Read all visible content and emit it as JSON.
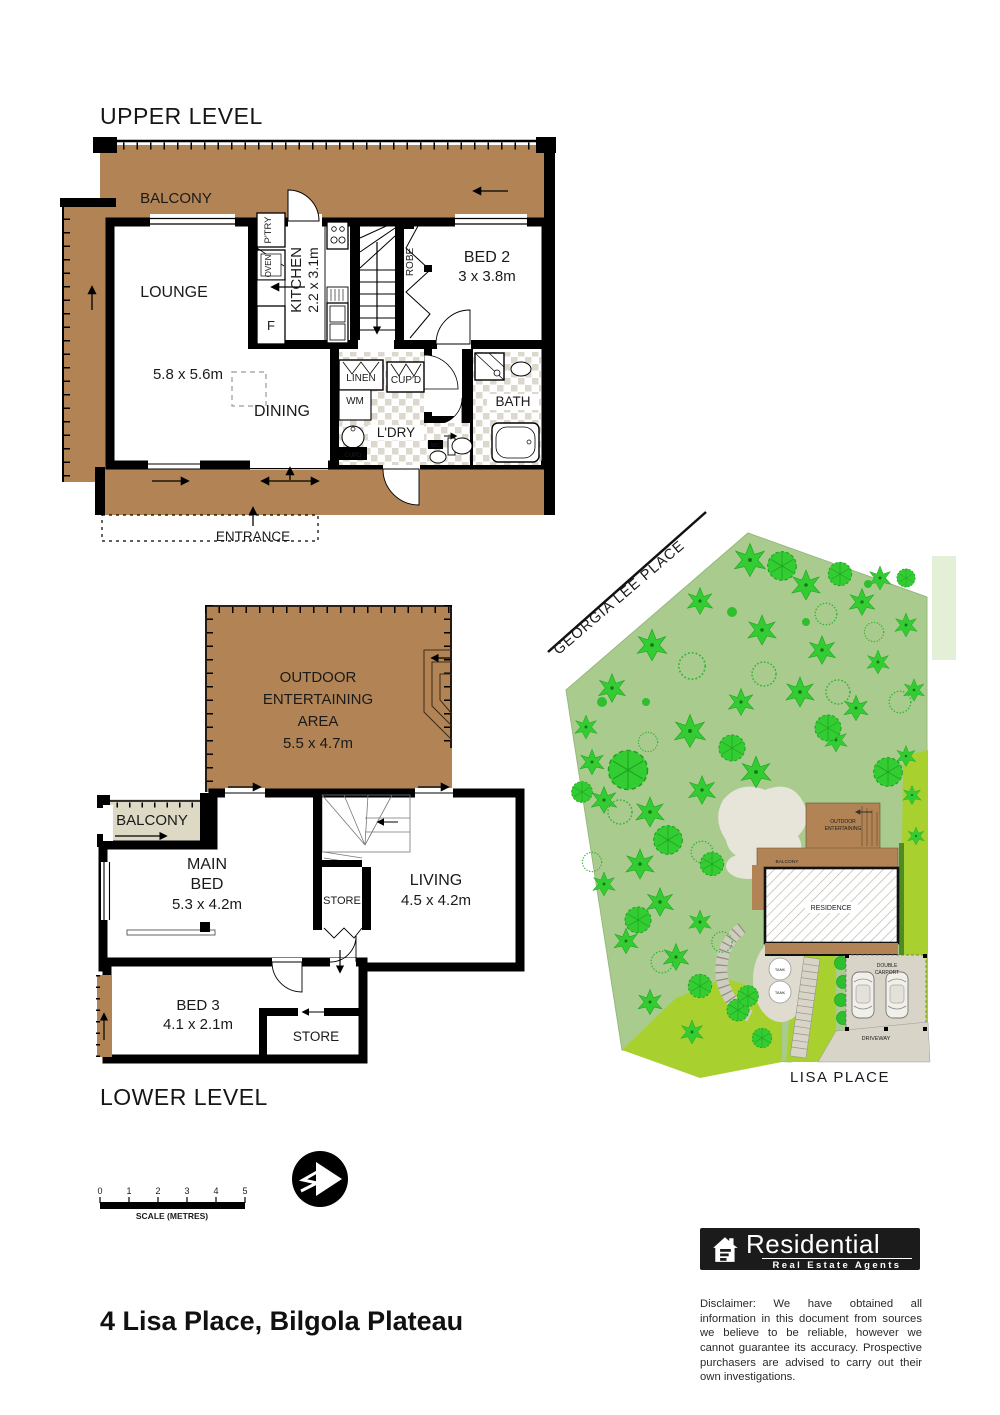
{
  "page": {
    "upper_title": "UPPER LEVEL",
    "lower_title": "LOWER LEVEL",
    "address": "4 Lisa Place, Bilgola Plateau"
  },
  "upper": {
    "balcony": "BALCONY",
    "lounge": "LOUNGE",
    "main_dim": "5.8 x 5.6m",
    "dining": "DINING",
    "kitchen": "KITCHEN",
    "kitchen_dim": "2.2 x 3.1m",
    "pantry": "P'TRY",
    "oven": "OVEN",
    "fridge": "F",
    "robe": "ROBE",
    "bed2": "BED 2",
    "bed2_dim": "3 x 3.8m",
    "linen": "LINEN",
    "cupboard": "CUP'D",
    "washing_machine": "WM",
    "laundry": "L'DRY",
    "cupboard_small": "CUPD",
    "bath": "BATH",
    "wc": "WC",
    "entrance": "ENTRANCE"
  },
  "lower": {
    "outdoor_line1": "OUTDOOR",
    "outdoor_line2": "ENTERTAINING",
    "outdoor_line3": "AREA",
    "outdoor_dim": "5.5 x 4.7m",
    "balcony": "BALCONY",
    "main_bed_line1": "MAIN",
    "main_bed_line2": "BED",
    "main_bed_dim": "5.3 x 4.2m",
    "store_mid": "STORE",
    "living": "LIVING",
    "living_dim": "4.5 x 4.2m",
    "bed3": "BED 3",
    "bed3_dim": "4.1 x 2.1m",
    "store_bottom": "STORE"
  },
  "site": {
    "street_top": "GEORGIA LEE PLACE",
    "street_bottom": "LISA PLACE",
    "outdoor_line1": "OUTDOOR",
    "outdoor_line2": "ENTERTAINING",
    "balcony": "BALCONY",
    "residence": "RESIDENCE",
    "tank1": "TANK",
    "tank2": "TANK",
    "carport_line1": "DOUBLE",
    "carport_line2": "CARPORT",
    "driveway": "DRIVEWAY"
  },
  "scalebar": {
    "ticks": [
      "0",
      "1",
      "2",
      "3",
      "4",
      "5"
    ],
    "label": "SCALE (METRES)"
  },
  "logo": {
    "name": "Residential",
    "tagline": "Real Estate Agents"
  },
  "disclaimer": "Disclaimer: We have obtained all information in this document from sources we believe to be reliable, however we cannot guarantee its accuracy. Prospective purchasers are advised to carry out their own investigations.",
  "colors": {
    "deck_brown": "#b28455",
    "balcony_beige": "#ddd9c5",
    "site_green": "#a9cc8e",
    "tree_green": "#33cc33",
    "lawn_green": "#a8d130",
    "path_grey": "#dad7cb",
    "wall_black": "#000000"
  }
}
